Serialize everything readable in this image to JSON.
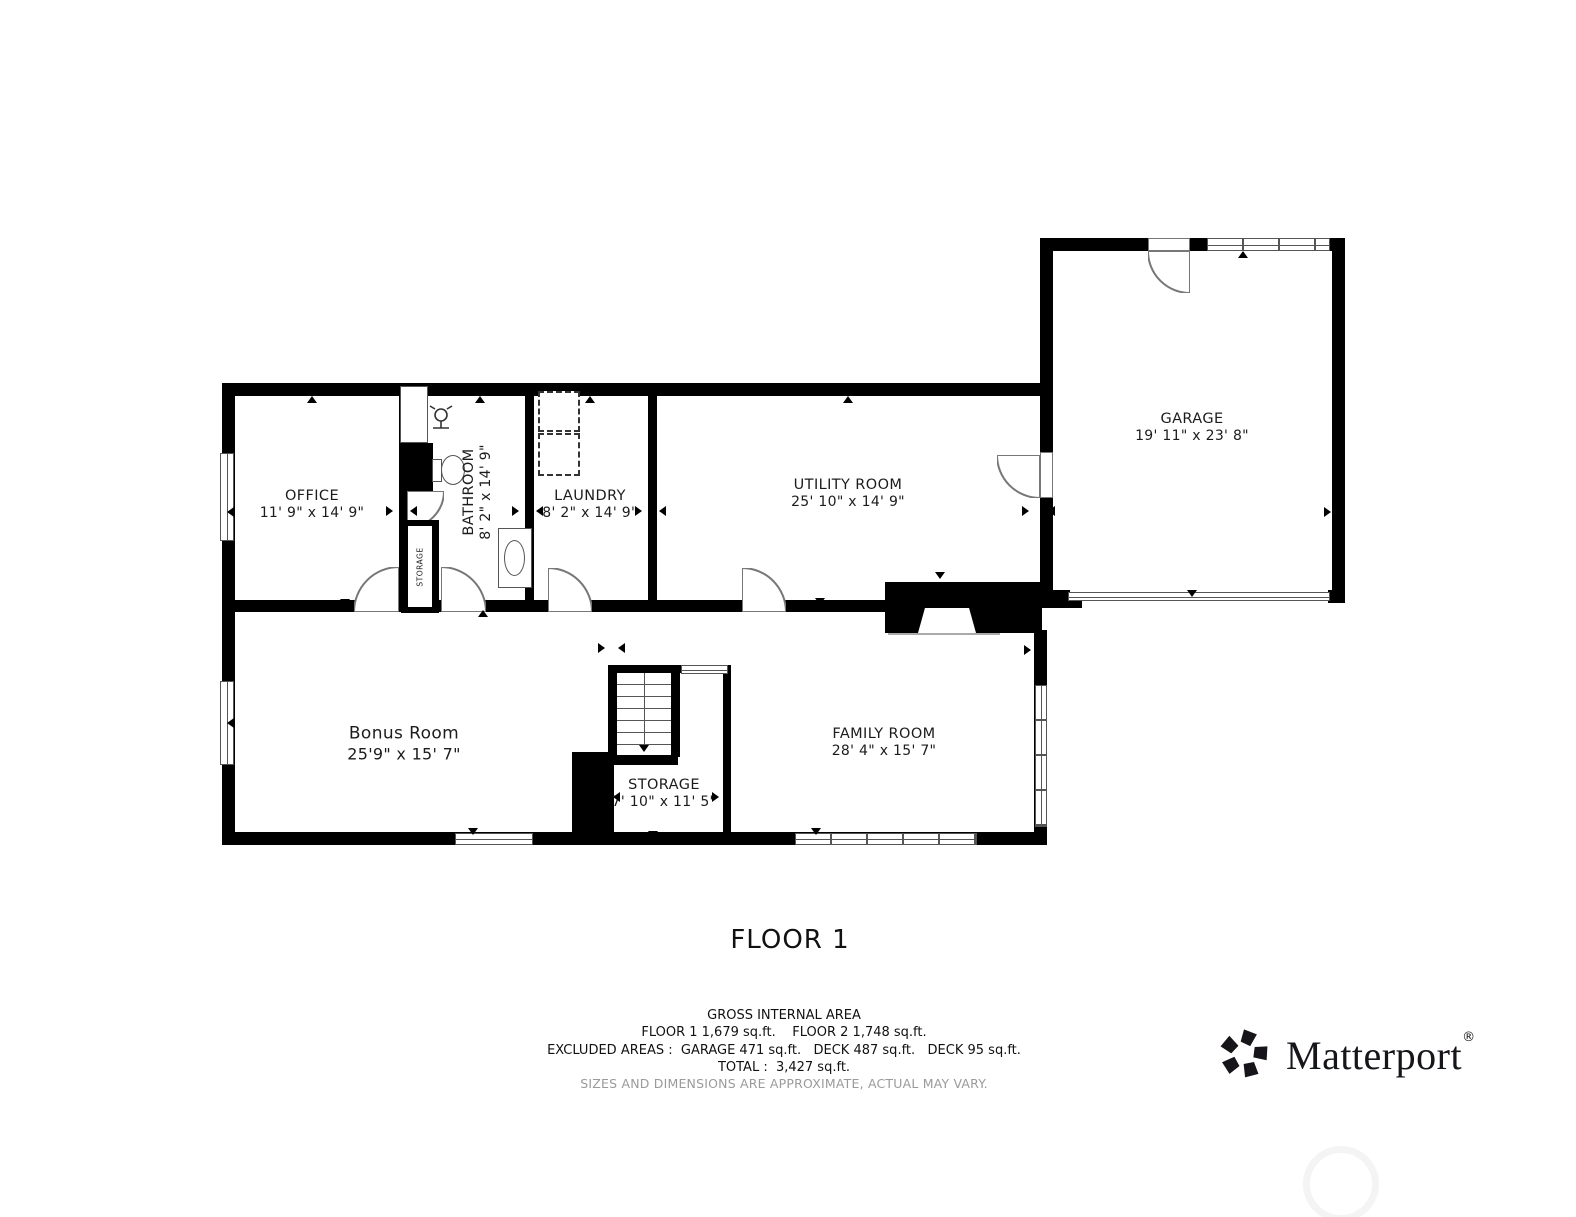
{
  "floor_plan": {
    "rooms": [
      {
        "name": "OFFICE",
        "dims": "11' 9\" x 14' 9\""
      },
      {
        "name": "BATHROOM",
        "dims": "8' 2\" x 14' 9\""
      },
      {
        "name": "LAUNDRY",
        "dims": "8' 2\" x 14' 9\""
      },
      {
        "name": "UTILITY ROOM",
        "dims": "25' 10\" x 14' 9\""
      },
      {
        "name": "GARAGE",
        "dims": "19' 11\" x 23' 8\""
      },
      {
        "name": "Bonus Room",
        "dims": "25'9\" x 15' 7\""
      },
      {
        "name": "STORAGE",
        "dims": "7' 10\" x 11' 5\""
      },
      {
        "name": "FAMILY ROOM",
        "dims": "28' 4\" x 15' 7\""
      }
    ],
    "closet_label": "STORAGE"
  },
  "caption": "FLOOR 1",
  "area_summary": {
    "heading": "GROSS INTERNAL AREA",
    "floors_line": "FLOOR 1 1,679 sq.ft.    FLOOR 2 1,748 sq.ft.",
    "excluded_line": "EXCLUDED AREAS :  GARAGE 471 sq.ft.   DECK 487 sq.ft.   DECK 95 sq.ft.",
    "total_line": "TOTAL :  3,427 sq.ft.",
    "note": "SIZES AND DIMENSIONS ARE APPROXIMATE, ACTUAL MAY VARY."
  },
  "branding": {
    "logo_text": "Matterport",
    "registered": "®"
  },
  "colors": {
    "wall": "#000000",
    "background": "#ffffff",
    "note_gray": "#9a9a9a"
  }
}
